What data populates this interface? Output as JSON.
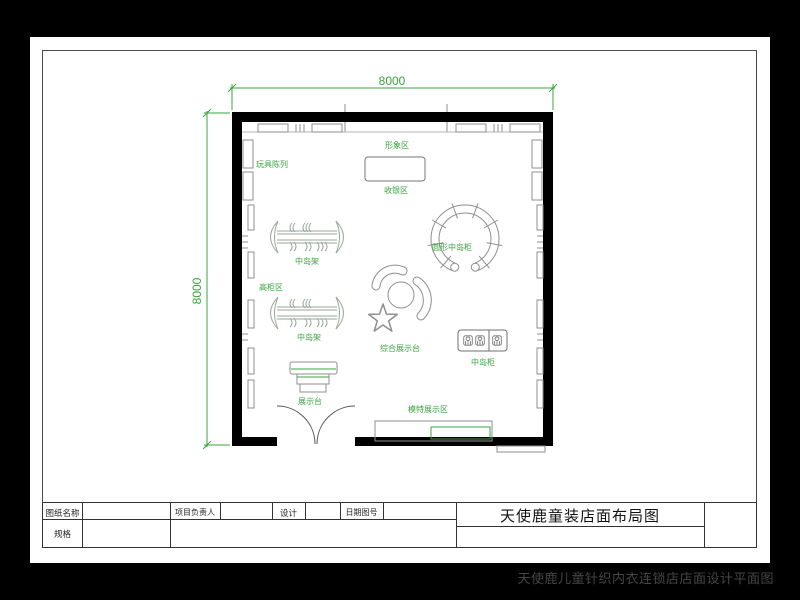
{
  "colors": {
    "background": "#000000",
    "paper": "#ffffff",
    "wall": "#000000",
    "fixture_gray": "#8f8f8f",
    "annotation_green": "#3aa43f"
  },
  "dimensions": {
    "width_mm": "8000",
    "height_mm": "8000"
  },
  "plan_labels": {
    "toy_display": "玩具陈列",
    "image_area": "形象区",
    "cashier_area": "收银区",
    "island_rack": "中岛架",
    "circular_island_cabinet": "圆形中岛柜",
    "tall_cabinet_area": "高柜区",
    "composite_display_stand": "综合展示台",
    "island_cabinet": "中岛柜",
    "display_stand": "展示台",
    "model_display_area": "模特展示区"
  },
  "title_block": {
    "drawing_name_label": "图纸名称",
    "spec_label": "规格",
    "project_leader_label": "项目负责人",
    "design_label": "设计",
    "date_drawing_no_label": "日期图号",
    "drawing_title": "天使鹿童装店面布局图"
  },
  "footer": {
    "caption": "天使鹿儿童针织内衣连锁店店面设计平面图"
  }
}
